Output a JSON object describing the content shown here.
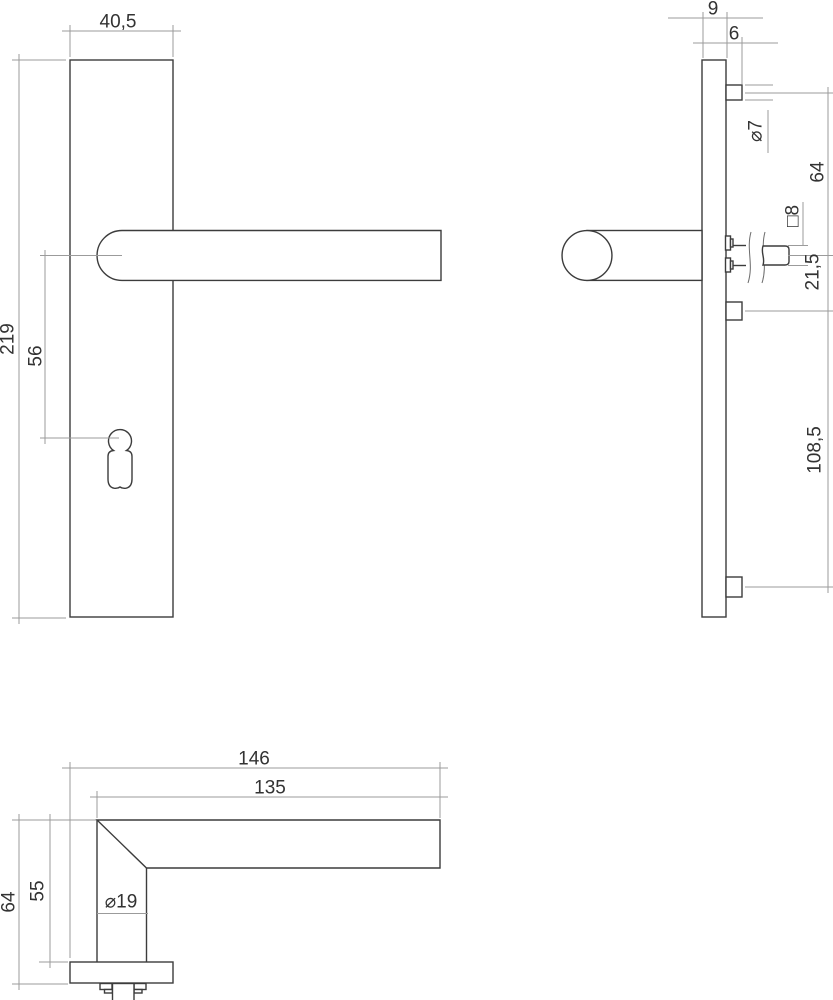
{
  "drawing": {
    "type": "technical-drawing",
    "subject": "door handle on backplate, three orthographic views",
    "front_view": {
      "plate_width_label": "40,5",
      "plate_height_label": "219",
      "handle_to_keyhole_label": "56"
    },
    "side_view": {
      "plate_thickness_label": "9",
      "boss_depth_label": "6",
      "screw_boss_dia_label": "⌀7",
      "screw_to_spindle_label": "64",
      "spindle_square_label": "□8",
      "spindle_to_screw_label": "21,5",
      "screw_spacing_label": "108,5"
    },
    "top_view": {
      "overall_length_label": "146",
      "grip_length_label": "135",
      "overall_depth_label": "64",
      "neck_depth_label": "55",
      "grip_dia_label": "⌀19"
    }
  },
  "colors": {
    "background": "#ffffff",
    "object_line": "#3c3c3c",
    "dimension_line": "#9b9b9b",
    "text": "#333333"
  }
}
